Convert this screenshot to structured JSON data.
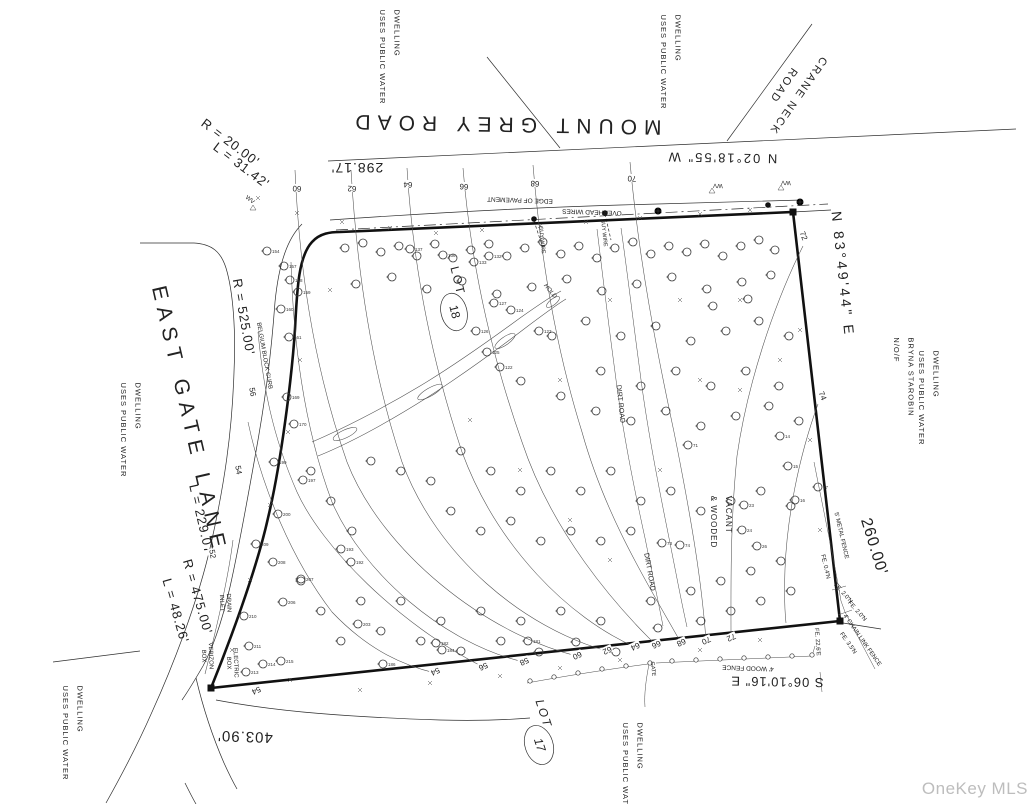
{
  "watermark": {
    "text": "OneKey MLS",
    "color": "#bdbdbd"
  },
  "streets": {
    "mount_grey_road": "MOUNT GREY ROAD",
    "crane_neck_road": "CRANE NECK\nROAD",
    "east_gate_lane": "EAST GATE LANE"
  },
  "bearings": {
    "north_line": "N 02°18'55\" W",
    "east_line": "N 83°49'44\" E",
    "south_line": "S 06°10'16\" E"
  },
  "dimensions": {
    "road_frontage": "298.17'",
    "east_side": "260.00'",
    "south_side": "403.90'"
  },
  "curves": {
    "corner_radius": "R = 20.00'",
    "corner_arc": "L = 31.42'",
    "lane_radius_1": "R = 525.00'",
    "lane_arc_1": "L = 229.07'",
    "lane_radius_2": "R = 475.00'",
    "lane_arc_2": "L = 48.26'"
  },
  "lots": {
    "lot18_label": "LOT",
    "lot18_number": "18",
    "lot17_label": "LOT",
    "lot17_number": "17"
  },
  "site_notes": {
    "vacant_wooded": "VACANT\n& WOODED",
    "dwelling_note": "DWELLING\nUSES PUBLIC WATER",
    "neighbor": "N/O/F\nBRYNA STAROBIN",
    "hold": "HOLD"
  },
  "features": {
    "edge_of_pavement": "EDGE OF PAVEMENT",
    "overhead_wires": "OVERHEAD WIRES",
    "guy_wire": "GUY WIRE",
    "belgium_block": "BELGIUM BLOCK CURB",
    "dirt_road": "DIRT ROAD",
    "drain_inlet": "DRAIN\nINLET",
    "verizon_box": "VERIZON\nBOX",
    "electric_box": "ELECTRIC\nBOX",
    "water_valve": "WV",
    "gate": "GATE"
  },
  "fences": {
    "metal_fence": "5' METAL FENCE",
    "chain_link": "4' CHAIN LINK FENCE",
    "wood_fence": "4' WOOD FENCE",
    "fe_04n": "FE. 0.4'N",
    "fe_20n_a": "FE. 2.0'N",
    "fe_20n_b": "FE. 2.0'N",
    "fe_35n": "FE. 3.5'N",
    "fe_226e": "FE. 22.6'E"
  },
  "contour_labels": [
    [
      60,
      297,
      188,
      183
    ],
    [
      62,
      352,
      188,
      183
    ],
    [
      64,
      408,
      184,
      183
    ],
    [
      66,
      464,
      186,
      183
    ],
    [
      68,
      535,
      183,
      183
    ],
    [
      70,
      632,
      178,
      183
    ],
    [
      72,
      803,
      236,
      68
    ],
    [
      74,
      822,
      396,
      68
    ],
    [
      54,
      435,
      671,
      155
    ],
    [
      56,
      483,
      666,
      155
    ],
    [
      58,
      524,
      661,
      155
    ],
    [
      60,
      577,
      655,
      155
    ],
    [
      62,
      607,
      650,
      155
    ],
    [
      64,
      635,
      646,
      155
    ],
    [
      66,
      656,
      644,
      155
    ],
    [
      68,
      681,
      642,
      155
    ],
    [
      70,
      706,
      640,
      155
    ],
    [
      72,
      731,
      637,
      155
    ],
    [
      52,
      212,
      554,
      80
    ],
    [
      54,
      238,
      470,
      80
    ],
    [
      56,
      252,
      392,
      80
    ],
    [
      54,
      256,
      690,
      155
    ]
  ],
  "tree_tags": [
    [
      154,
      267,
      251
    ],
    [
      157,
      284,
      266
    ],
    [
      158,
      290,
      280
    ],
    [
      159,
      298,
      292
    ],
    [
      160,
      281,
      309
    ],
    [
      161,
      289,
      337
    ],
    [
      169,
      287,
      397
    ],
    [
      170,
      294,
      424
    ],
    [
      199,
      274,
      462
    ],
    [
      197,
      303,
      480
    ],
    [
      200,
      278,
      514
    ],
    [
      209,
      256,
      544
    ],
    [
      208,
      273,
      562
    ],
    [
      207,
      301,
      579
    ],
    [
      206,
      283,
      602
    ],
    [
      210,
      244,
      616
    ],
    [
      211,
      249,
      646
    ],
    [
      213,
      246,
      672
    ],
    [
      214,
      263,
      664
    ],
    [
      215,
      281,
      661
    ],
    [
      193,
      341,
      549
    ],
    [
      192,
      351,
      562
    ],
    [
      203,
      358,
      624
    ],
    [
      137,
      410,
      249
    ],
    [
      136,
      443,
      255
    ],
    [
      133,
      474,
      262
    ],
    [
      132,
      489,
      256
    ],
    [
      127,
      494,
      303
    ],
    [
      126,
      476,
      331
    ],
    [
      124,
      511,
      310
    ],
    [
      125,
      487,
      352
    ],
    [
      123,
      539,
      331
    ],
    [
      122,
      500,
      367
    ],
    [
      181,
      528,
      641
    ],
    [
      182,
      436,
      643
    ],
    [
      184,
      442,
      650
    ],
    [
      186,
      383,
      664
    ],
    [
      17,
      818,
      487
    ],
    [
      16,
      795,
      500
    ],
    [
      15,
      788,
      466
    ],
    [
      14,
      780,
      436
    ],
    [
      26,
      757,
      546
    ],
    [
      24,
      742,
      530
    ],
    [
      23,
      744,
      505
    ],
    [
      71,
      688,
      445
    ],
    [
      73,
      662,
      543
    ],
    [
      74,
      680,
      545
    ]
  ],
  "trees": [
    [
      345,
      248
    ],
    [
      363,
      243
    ],
    [
      381,
      252
    ],
    [
      399,
      246
    ],
    [
      417,
      256
    ],
    [
      435,
      244
    ],
    [
      453,
      258
    ],
    [
      471,
      250
    ],
    [
      489,
      244
    ],
    [
      507,
      256
    ],
    [
      525,
      248
    ],
    [
      543,
      242
    ],
    [
      561,
      254
    ],
    [
      579,
      246
    ],
    [
      597,
      258
    ],
    [
      615,
      248
    ],
    [
      633,
      242
    ],
    [
      651,
      254
    ],
    [
      669,
      246
    ],
    [
      687,
      252
    ],
    [
      705,
      244
    ],
    [
      723,
      256
    ],
    [
      741,
      246
    ],
    [
      759,
      240
    ],
    [
      775,
      250
    ],
    [
      356,
      284
    ],
    [
      392,
      277
    ],
    [
      427,
      289
    ],
    [
      462,
      281
    ],
    [
      497,
      294
    ],
    [
      532,
      287
    ],
    [
      567,
      279
    ],
    [
      602,
      291
    ],
    [
      637,
      284
    ],
    [
      672,
      277
    ],
    [
      707,
      289
    ],
    [
      742,
      282
    ],
    [
      771,
      275
    ],
    [
      552,
      336
    ],
    [
      586,
      321
    ],
    [
      621,
      336
    ],
    [
      656,
      326
    ],
    [
      691,
      341
    ],
    [
      726,
      331
    ],
    [
      759,
      321
    ],
    [
      789,
      336
    ],
    [
      601,
      371
    ],
    [
      641,
      386
    ],
    [
      676,
      371
    ],
    [
      711,
      386
    ],
    [
      746,
      371
    ],
    [
      779,
      386
    ],
    [
      561,
      396
    ],
    [
      521,
      381
    ],
    [
      596,
      411
    ],
    [
      631,
      421
    ],
    [
      666,
      411
    ],
    [
      701,
      426
    ],
    [
      736,
      416
    ],
    [
      769,
      406
    ],
    [
      799,
      421
    ],
    [
      713,
      306
    ],
    [
      748,
      299
    ],
    [
      311,
      471
    ],
    [
      331,
      501
    ],
    [
      352,
      531
    ],
    [
      461,
      451
    ],
    [
      491,
      471
    ],
    [
      521,
      491
    ],
    [
      551,
      471
    ],
    [
      581,
      491
    ],
    [
      611,
      471
    ],
    [
      641,
      501
    ],
    [
      671,
      491
    ],
    [
      701,
      511
    ],
    [
      731,
      501
    ],
    [
      761,
      491
    ],
    [
      791,
      506
    ],
    [
      431,
      481
    ],
    [
      401,
      471
    ],
    [
      371,
      461
    ],
    [
      451,
      511
    ],
    [
      481,
      531
    ],
    [
      511,
      521
    ],
    [
      541,
      541
    ],
    [
      571,
      531
    ],
    [
      601,
      541
    ],
    [
      631,
      531
    ],
    [
      301,
      581
    ],
    [
      321,
      611
    ],
    [
      341,
      641
    ],
    [
      381,
      631
    ],
    [
      421,
      641
    ],
    [
      461,
      651
    ],
    [
      501,
      641
    ],
    [
      539,
      652
    ],
    [
      576,
      642
    ],
    [
      616,
      652
    ],
    [
      658,
      628
    ],
    [
      701,
      621
    ],
    [
      731,
      611
    ],
    [
      761,
      601
    ],
    [
      791,
      591
    ],
    [
      361,
      601
    ],
    [
      401,
      601
    ],
    [
      441,
      621
    ],
    [
      481,
      611
    ],
    [
      521,
      621
    ],
    [
      561,
      611
    ],
    [
      601,
      621
    ],
    [
      651,
      601
    ],
    [
      691,
      591
    ],
    [
      721,
      581
    ],
    [
      751,
      571
    ],
    [
      781,
      561
    ]
  ],
  "x_marks": [
    [
      258,
      198
    ],
    [
      297,
      213
    ],
    [
      342,
      222
    ],
    [
      390,
      228
    ],
    [
      436,
      233
    ],
    [
      482,
      230
    ],
    [
      540,
      226
    ],
    [
      586,
      222
    ],
    [
      640,
      218
    ],
    [
      700,
      214
    ],
    [
      750,
      210
    ],
    [
      330,
      290
    ],
    [
      300,
      360
    ],
    [
      288,
      432
    ],
    [
      270,
      505
    ],
    [
      250,
      580
    ],
    [
      232,
      650
    ],
    [
      290,
      680
    ],
    [
      360,
      690
    ],
    [
      430,
      683
    ],
    [
      500,
      676
    ],
    [
      560,
      668
    ],
    [
      620,
      660
    ],
    [
      700,
      650
    ],
    [
      760,
      640
    ],
    [
      820,
      530
    ],
    [
      810,
      440
    ],
    [
      800,
      330
    ],
    [
      470,
      420
    ],
    [
      520,
      470
    ],
    [
      570,
      520
    ],
    [
      610,
      560
    ],
    [
      660,
      470
    ],
    [
      700,
      380
    ],
    [
      560,
      380
    ],
    [
      610,
      300
    ],
    [
      680,
      300
    ],
    [
      740,
      300
    ],
    [
      780,
      360
    ],
    [
      740,
      390
    ]
  ],
  "symbols": {
    "fence_posts": [
      [
        530,
        681
      ],
      [
        554,
        677
      ],
      [
        578,
        673
      ],
      [
        602,
        669
      ],
      [
        626,
        666
      ],
      [
        650,
        663
      ],
      [
        672,
        661
      ],
      [
        696,
        660
      ],
      [
        720,
        659
      ],
      [
        744,
        658
      ],
      [
        768,
        657
      ],
      [
        792,
        656
      ],
      [
        812,
        655
      ]
    ],
    "utility_poles": [
      [
        534,
        219
      ],
      [
        605,
        213
      ],
      [
        768,
        205
      ]
    ],
    "pole_crosses": [
      [
        658,
        211
      ],
      [
        800,
        202
      ]
    ],
    "corner_monuments": [
      [
        793,
        212
      ],
      [
        840,
        621
      ],
      [
        211,
        688
      ]
    ],
    "water_valves": [
      [
        253,
        208
      ],
      [
        712,
        191
      ],
      [
        781,
        188
      ]
    ]
  }
}
